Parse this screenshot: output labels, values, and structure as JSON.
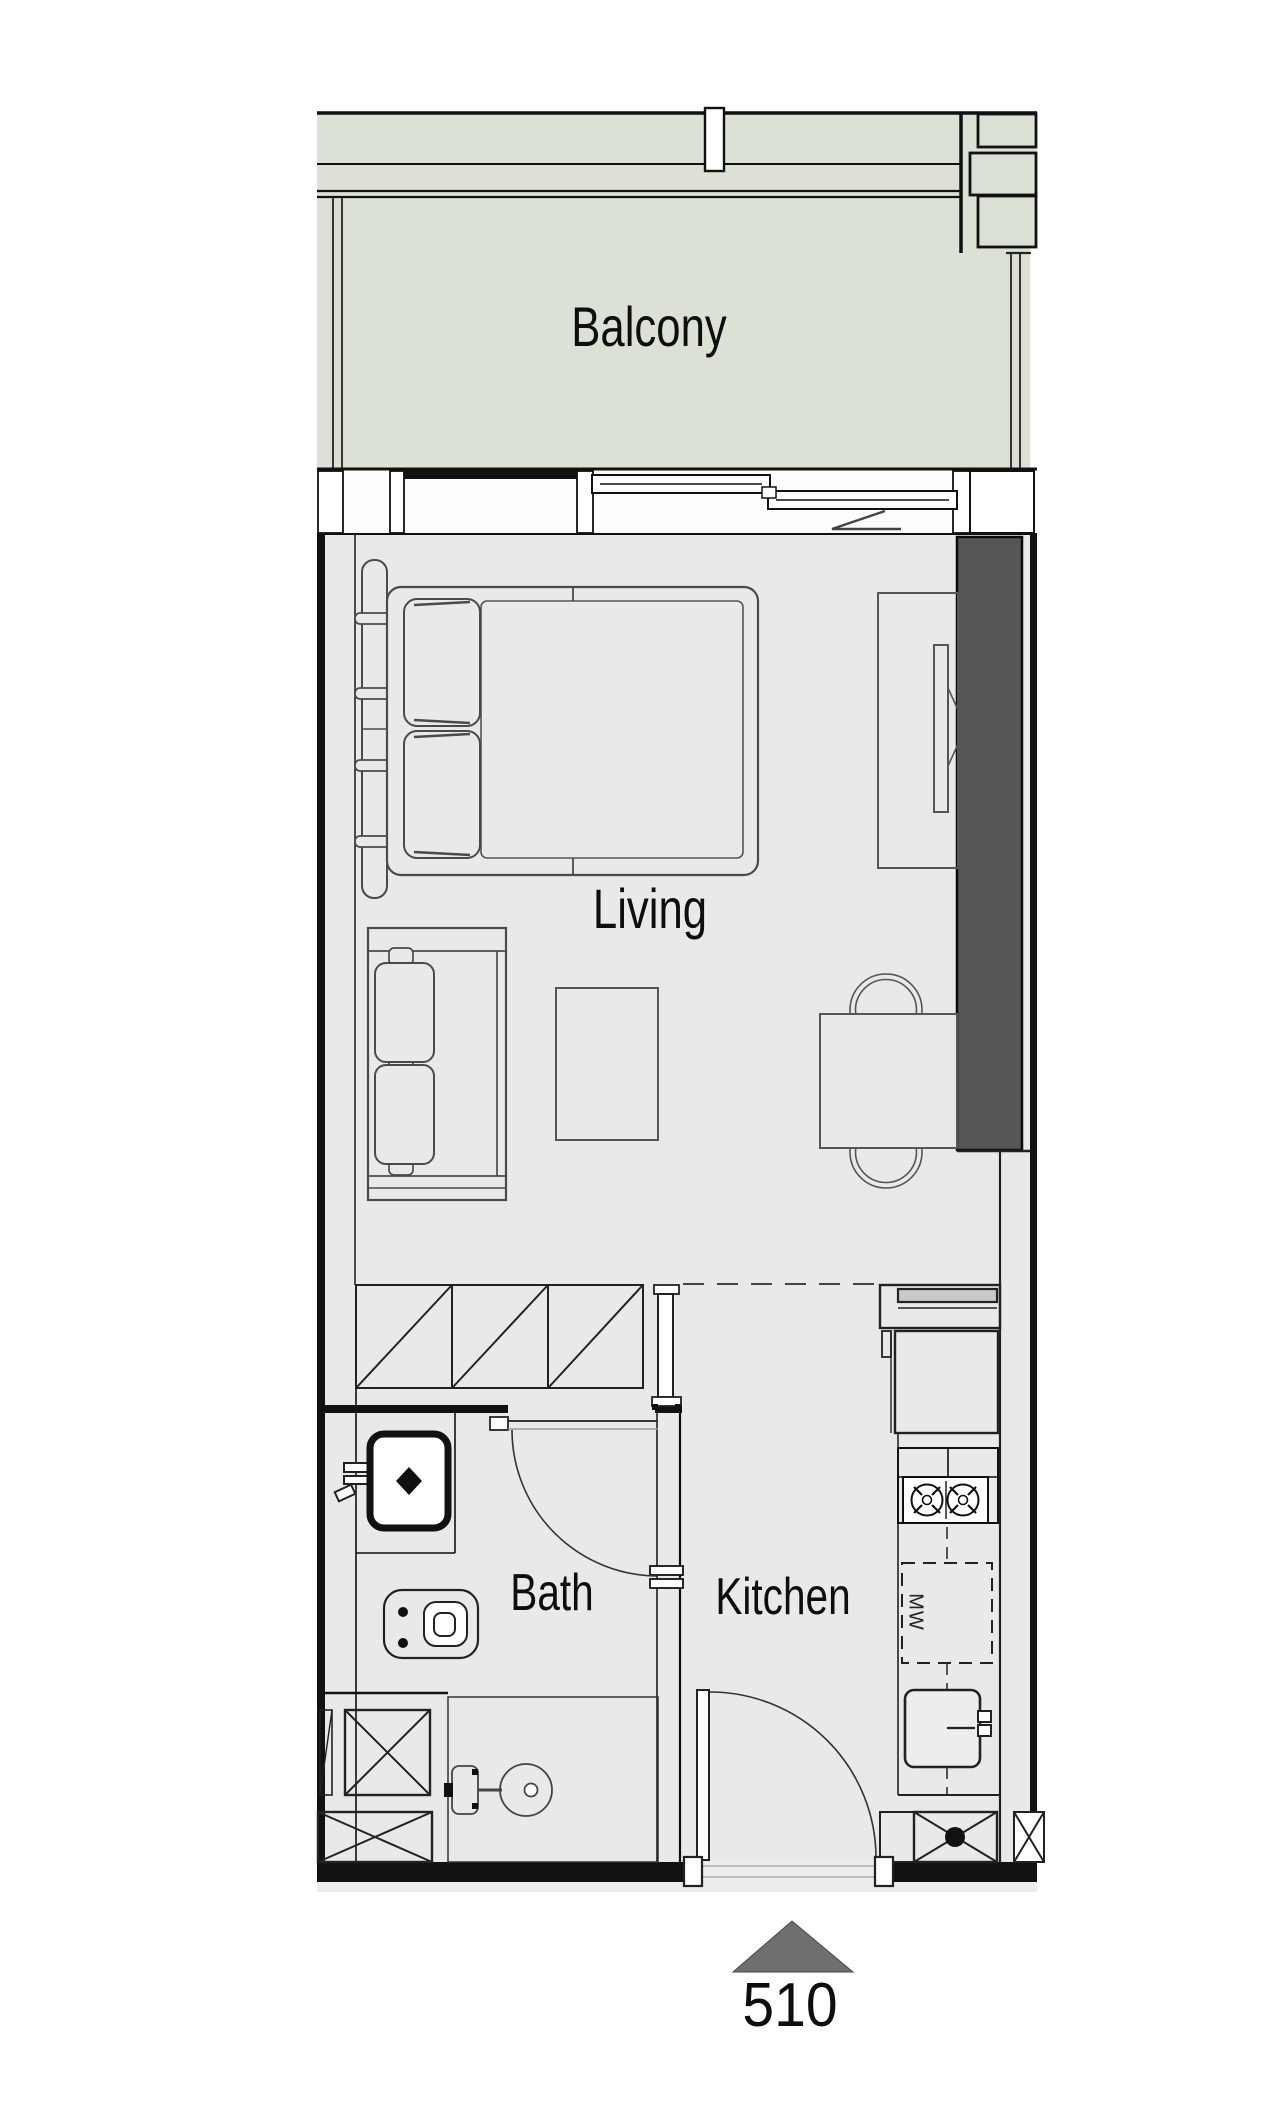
{
  "plan": {
    "unit_number": "510",
    "labels": {
      "balcony": "Balcony",
      "living": "Living",
      "bath": "Bath",
      "kitchen": "Kitchen",
      "microwave": "MW",
      "unit": "510"
    },
    "colors": {
      "balcony_fill": "#dce1d6",
      "floor_fill": "#e9e9e7",
      "feature_wall": "#565659",
      "wall_line": "#111111",
      "furniture_line": "#4a4a4a",
      "entry_marker_fill": "#6f6f6f"
    },
    "symbols": {
      "entry_marker": "triangle-up-icon",
      "service_shaft": "crossed-box-icon",
      "stove": "two-burner-icon",
      "door_swing": "quarter-arc-icon"
    }
  }
}
